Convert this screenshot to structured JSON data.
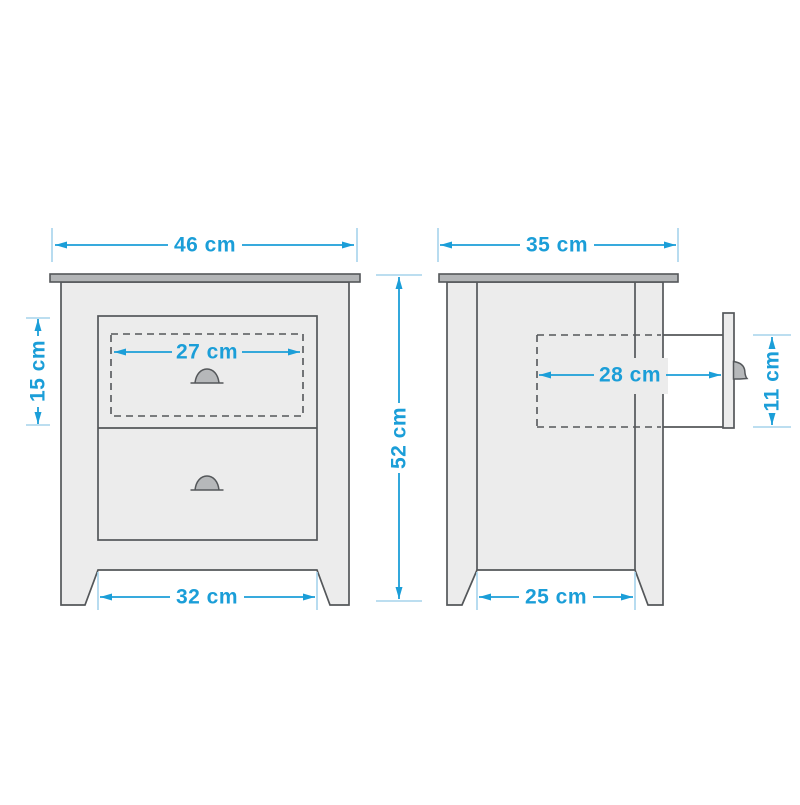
{
  "diagram": {
    "kind": "furniture-dimension-drawing",
    "views": {
      "front": {
        "dimensions": {
          "top_width": {
            "label": "46 cm",
            "value": 46,
            "unit": "cm"
          },
          "drawer_width": {
            "label": "27 cm",
            "value": 27,
            "unit": "cm"
          },
          "drawer_height": {
            "label": "15 cm",
            "value": 15,
            "unit": "cm"
          },
          "overall_height": {
            "label": "52 cm",
            "value": 52,
            "unit": "cm"
          },
          "base_width": {
            "label": "32 cm",
            "value": 32,
            "unit": "cm"
          }
        }
      },
      "side": {
        "dimensions": {
          "top_depth": {
            "label": "35 cm",
            "value": 35,
            "unit": "cm"
          },
          "drawer_depth": {
            "label": "28 cm",
            "value": 28,
            "unit": "cm"
          },
          "drawer_side_height": {
            "label": "11 cm",
            "value": 11,
            "unit": "cm"
          },
          "base_depth": {
            "label": "25 cm",
            "value": 25,
            "unit": "cm"
          }
        }
      }
    },
    "colors": {
      "dimension_blue": "#1b9ed8",
      "tick_light_blue": "#a6d4ec",
      "outline_gray": "#54575a",
      "top_panel_gray": "#b3b5b7",
      "body_light_gray": "#ececec",
      "background": "#ffffff"
    }
  }
}
